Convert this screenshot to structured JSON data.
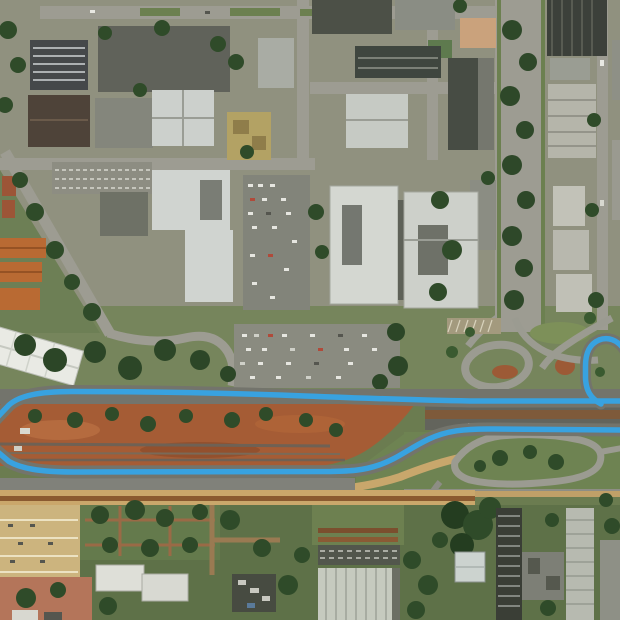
{
  "map": {
    "view_type": "satellite-aerial",
    "description": "Aerial satellite view of an urban district bisected by a highway corridor under construction (red-earth median); a blue route overlay follows both carriageways, makes a U-turn beyond the left edge and exits via a cloverleaf loop ramp at the upper right.",
    "route": {
      "color": "#38a2e0",
      "width": 5.5,
      "underlay_color": "#73746c",
      "underlay_width": 13,
      "segments": [
        {
          "name": "north-carriageway-route",
          "d": "M 628 401 L 470 401 C 410 400 360 398 305 396 C 225 393 140 391.5 72 391.5 C 38 391.5 19 396 9 405 L -8 423"
        },
        {
          "name": "south-carriageway-route",
          "d": "M 628 430 L 494 429 C 464 428.5 446 431 429 439 C 407 449.5 399 458 379 465 C 363 470.5 351 471 331 471.5 L 74 472 C 40 472 21 468.5 9 461.5 L -8 447"
        },
        {
          "name": "cloverleaf-ramp-route",
          "d": "M 601 404 C 590 398 586 390 585.5 378 L 585.5 366 C 585.5 352 590 344 599 340 C 608 336.5 617 340 623 348 L 630 358"
        }
      ]
    },
    "palette": {
      "grass": "#6b7c50",
      "grass_light": "#76855c",
      "city_ground": "#90917f",
      "road_gray": "#9d9c92",
      "highway_dark": "#63645c",
      "dirt_red": "#a55c35",
      "dirt_pink": "#b4755a",
      "tree_green": "#2f4b29",
      "building_light": "#d2d5cf",
      "building_dark": "#42463f",
      "parking_tan": "#ccb47e",
      "strip_tan": "#caa76b",
      "roof_orange": "#b96a33"
    }
  }
}
